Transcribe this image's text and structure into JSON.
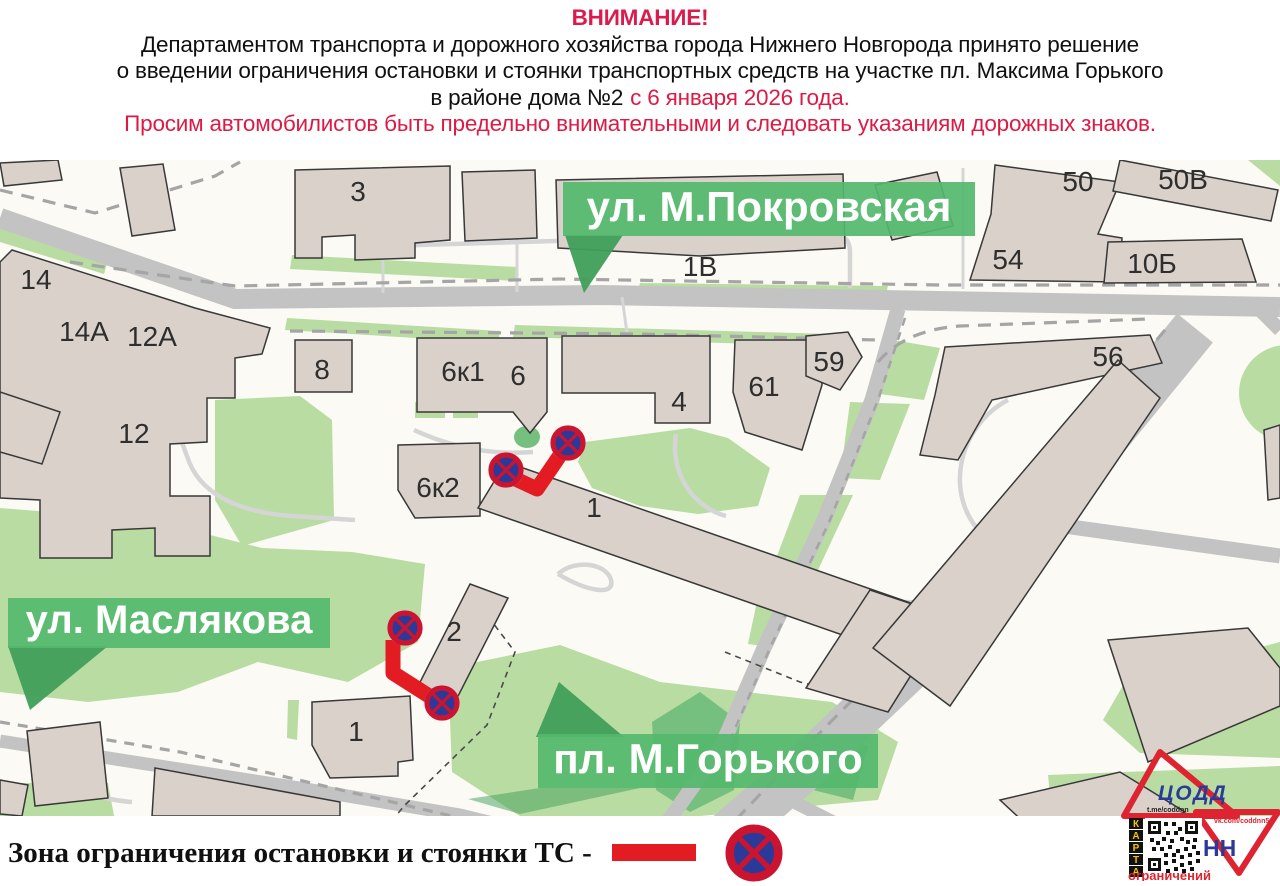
{
  "header": {
    "attention": "ВНИМАНИЕ!",
    "line1": "Департаментом транспорта и дорожного хозяйства города Нижнего Новгорода принято решение",
    "line2": "о введении ограничения остановки и стоянки транспортных средств на участке пл. Максима Горького",
    "line3_black": "в районе дома №2",
    "line3_red": "с 6 января 2026 года.",
    "line4": "Просим автомобилистов быть предельно внимательными и следовать указаниям дорожных знаков."
  },
  "map": {
    "banners": {
      "pokrovskaya": "ул. М.Покровская",
      "maslyakova": "ул. Маслякова",
      "gorkogo": "пл. М.Горького"
    },
    "building_labels": [
      "3",
      "1В",
      "50",
      "50В",
      "54",
      "10Б",
      "14",
      "14А",
      "12А",
      "8",
      "6к1",
      "6",
      "4",
      "61",
      "59",
      "56",
      "12",
      "6к2",
      "1",
      "2",
      "1"
    ]
  },
  "legend": {
    "label": "Зона ограничения остановки и стоянки ТС -"
  },
  "logo": {
    "org": "ЦОДД",
    "city": "НН",
    "telegram": "t.me/coddnn",
    "vk": "vk.com/coddnn52",
    "karta": [
      "К",
      "А",
      "Р",
      "Т",
      "А"
    ],
    "caption": "ограничений"
  },
  "colors": {
    "accent_red": "#e31b22",
    "header_red": "#de1a44",
    "sign_blue": "#2b3a99",
    "banner_green": "#54b96c",
    "map_green": "#b9dca2",
    "building": "#d9d1ca",
    "road": "#c3c3c3"
  }
}
